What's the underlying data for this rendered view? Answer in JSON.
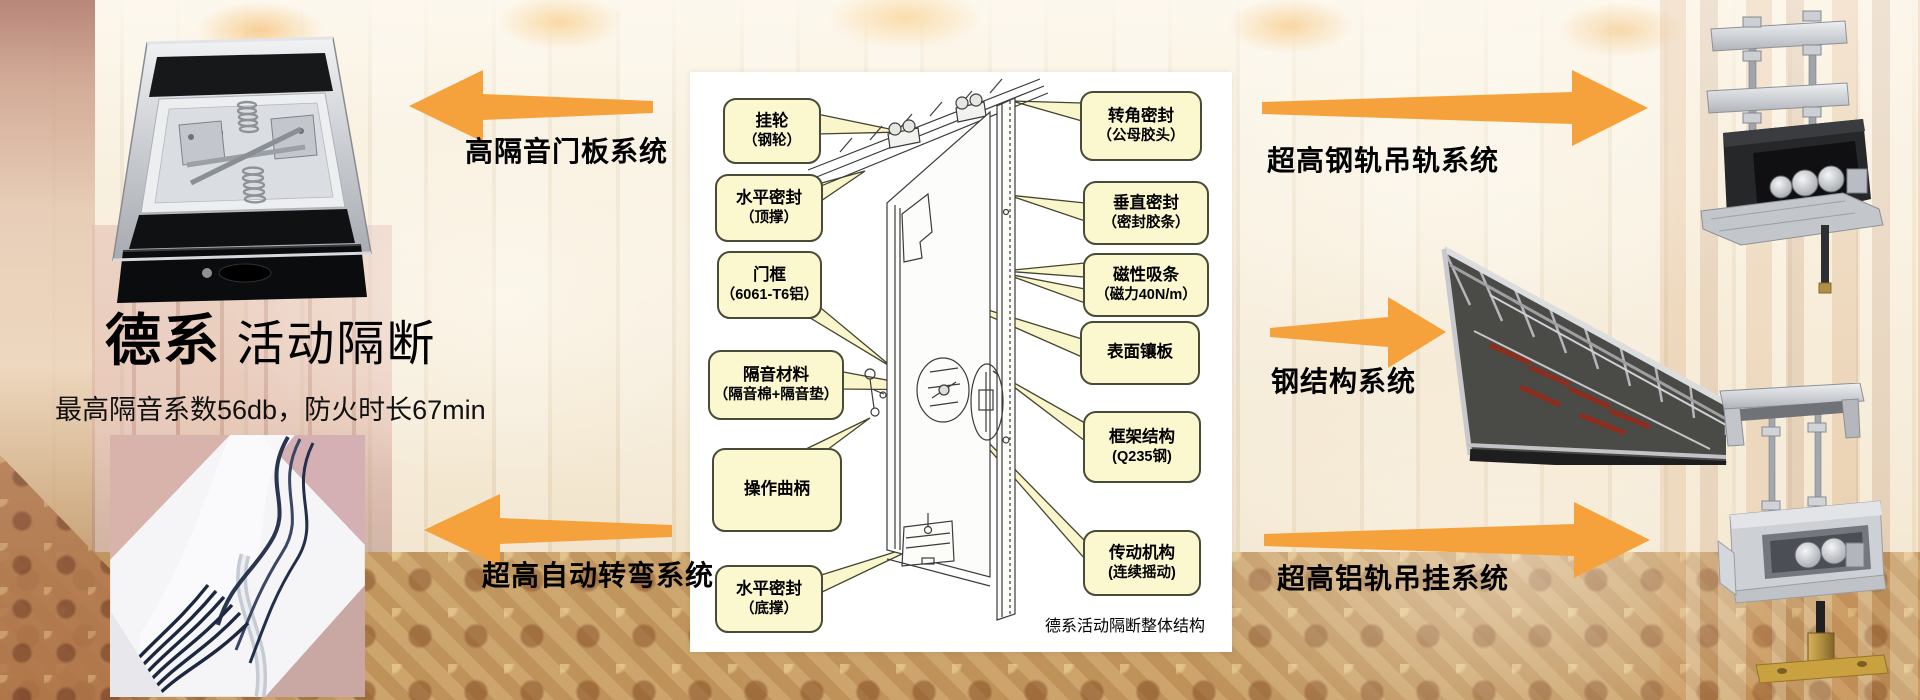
{
  "title": {
    "bold": "德系",
    "rest": " 活动隔断",
    "subtitle": "最高隔音系数56db，防火时长67min"
  },
  "system_labels": {
    "door_panel": "高隔音门板系统",
    "auto_turn": "超高自动转弯系统",
    "steel_rail": "超高钢轨吊轨系统",
    "steel_structure": "钢结构系统",
    "alu_rail": "超高铝轨吊挂系统"
  },
  "diagram": {
    "caption": "德系活动隔断整体结构",
    "callouts_left": [
      {
        "l1": "挂轮",
        "l2": "（钢轮）"
      },
      {
        "l1": "水平密封",
        "l2": "（顶撑）"
      },
      {
        "l1": "门框",
        "l2": "（6061-T6铝）"
      },
      {
        "l1": "隔音材料",
        "l2": "（隔音棉+隔音垫）"
      },
      {
        "l1": "操作曲柄",
        "l2": ""
      },
      {
        "l1": "水平密封",
        "l2": "（底撑）"
      }
    ],
    "callouts_right": [
      {
        "l1": "转角密封",
        "l2": "（公母胶头）"
      },
      {
        "l1": "垂直密封",
        "l2": "（密封胶条）"
      },
      {
        "l1": "磁性吸条",
        "l2": "（磁力40N/m）"
      },
      {
        "l1": "表面镶板",
        "l2": ""
      },
      {
        "l1": "框架结构",
        "l2": "(Q235钢)"
      },
      {
        "l1": "传动机构",
        "l2": "(连续摇动)"
      }
    ]
  },
  "colors": {
    "arrow": "#F6A23C",
    "callout_fill": "#FBF8D0",
    "callout_border": "#4A4A38",
    "panel": "#FFFFFF",
    "text": "#000000"
  }
}
